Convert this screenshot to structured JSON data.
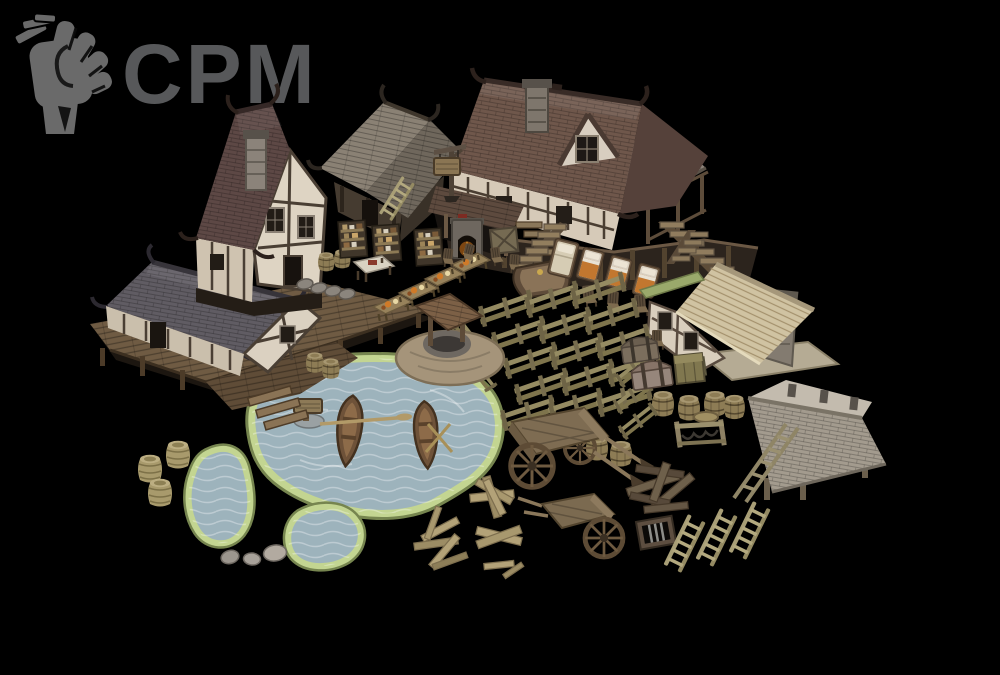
{
  "canvas": {
    "width": 1000,
    "height": 675,
    "background": "#000000"
  },
  "logo": {
    "text": "CPM",
    "icon": "raised-fist-icon",
    "icon_color": "#6a6a6a",
    "text_color": "#57585a"
  },
  "scene": {
    "kind": "medieval-village-3d-asset-pack-render",
    "palette": {
      "tavern_roof": "#6f574b",
      "townhouse_roof": "#5d4845",
      "slate_roof": "#605c63",
      "shelter_roof": "#a39b8e",
      "thatch_roof": "#d0c3a2",
      "plaster_wall": "#ddd2c0",
      "timber": "#4a3f34",
      "deck_wood": "#6f5b43",
      "water": "#9db3bc",
      "shore_green": "#c3d591",
      "fence_wood": "#958b62",
      "fire_glow": "#ffb03a"
    },
    "assets": [
      {
        "name": "large-tavern",
        "count": 1
      },
      {
        "name": "tall-townhouse",
        "count": 1
      },
      {
        "name": "wooden-shack",
        "count": 1
      },
      {
        "name": "dock-house-with-pier",
        "count": 1
      },
      {
        "name": "thatched-cottage",
        "count": 1
      },
      {
        "name": "roof-shelter",
        "count": 1
      },
      {
        "name": "stone-well",
        "count": 1
      },
      {
        "name": "lake",
        "count": 1
      },
      {
        "name": "ponds",
        "count": 2
      },
      {
        "name": "rowboats",
        "count": 2
      },
      {
        "name": "oars",
        "count": 3
      },
      {
        "name": "fence-segments",
        "count": 19
      },
      {
        "name": "hanging-sign-post",
        "count": 1
      },
      {
        "name": "lake-sign",
        "count": 1
      },
      {
        "name": "shelf-units",
        "count": 3
      },
      {
        "name": "tables",
        "count": 5
      },
      {
        "name": "chairs",
        "count": 8
      },
      {
        "name": "beds",
        "count": 4
      },
      {
        "name": "fireplace",
        "count": 1
      },
      {
        "name": "staircases",
        "count": 4
      },
      {
        "name": "bar-counter",
        "count": 1
      },
      {
        "name": "chests",
        "count": 2
      },
      {
        "name": "crates",
        "count": 2
      },
      {
        "name": "barrels",
        "count": 10
      },
      {
        "name": "barrel-lid",
        "count": 1
      },
      {
        "name": "wicker-barrels",
        "count": 3
      },
      {
        "name": "carts",
        "count": 2
      },
      {
        "name": "ladders",
        "count": 5
      },
      {
        "name": "wood-plank-piles",
        "count": 4
      },
      {
        "name": "debris-pile",
        "count": 1
      },
      {
        "name": "window-grate",
        "count": 1
      },
      {
        "name": "bench-frame",
        "count": 1
      },
      {
        "name": "stepping-stones",
        "count": 4
      },
      {
        "name": "stones",
        "count": 3
      }
    ]
  }
}
